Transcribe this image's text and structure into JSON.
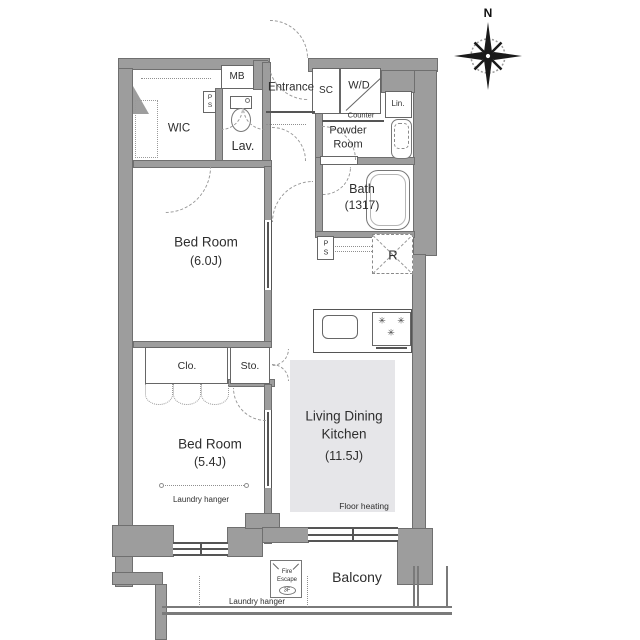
{
  "compass": {
    "north": "N"
  },
  "labels": {
    "wic": "WIC",
    "mb": "MB",
    "entrance": "Entrance",
    "sc": "SC",
    "wd": "W/D",
    "counter": "Counter",
    "lin": "Lin.",
    "lav": "Lav.",
    "powder1": "Powder",
    "powder2": "Room",
    "bath": "Bath",
    "bath_size": "(1317)",
    "ps_p": "P",
    "ps_s": "S",
    "r": "R",
    "bed1": "Bed Room",
    "bed1_size": "(6.0J)",
    "clo": "Clo.",
    "sto": "Sto.",
    "bed2": "Bed Room",
    "bed2_size": "(5.4J)",
    "laundry_room": "Laundry hanger",
    "ldk1": "Living Dining",
    "ldk2": "Kitchen",
    "ldk_size": "(11.5J)",
    "floor_heating": "Floor heating",
    "balcony": "Balcony",
    "fe1": "Fire",
    "fe2": "Escape",
    "fe3": "3F",
    "laundry_balcony": "Laundry hanger"
  },
  "icons": {
    "burner": "✳"
  },
  "colors": {
    "wall": "#9d9d9d",
    "wall_edge": "#6f6f6f",
    "floor_heating_fill": "#e6e6e9",
    "text": "#2e2e2e",
    "dashed_line": "#8f8f8f"
  }
}
